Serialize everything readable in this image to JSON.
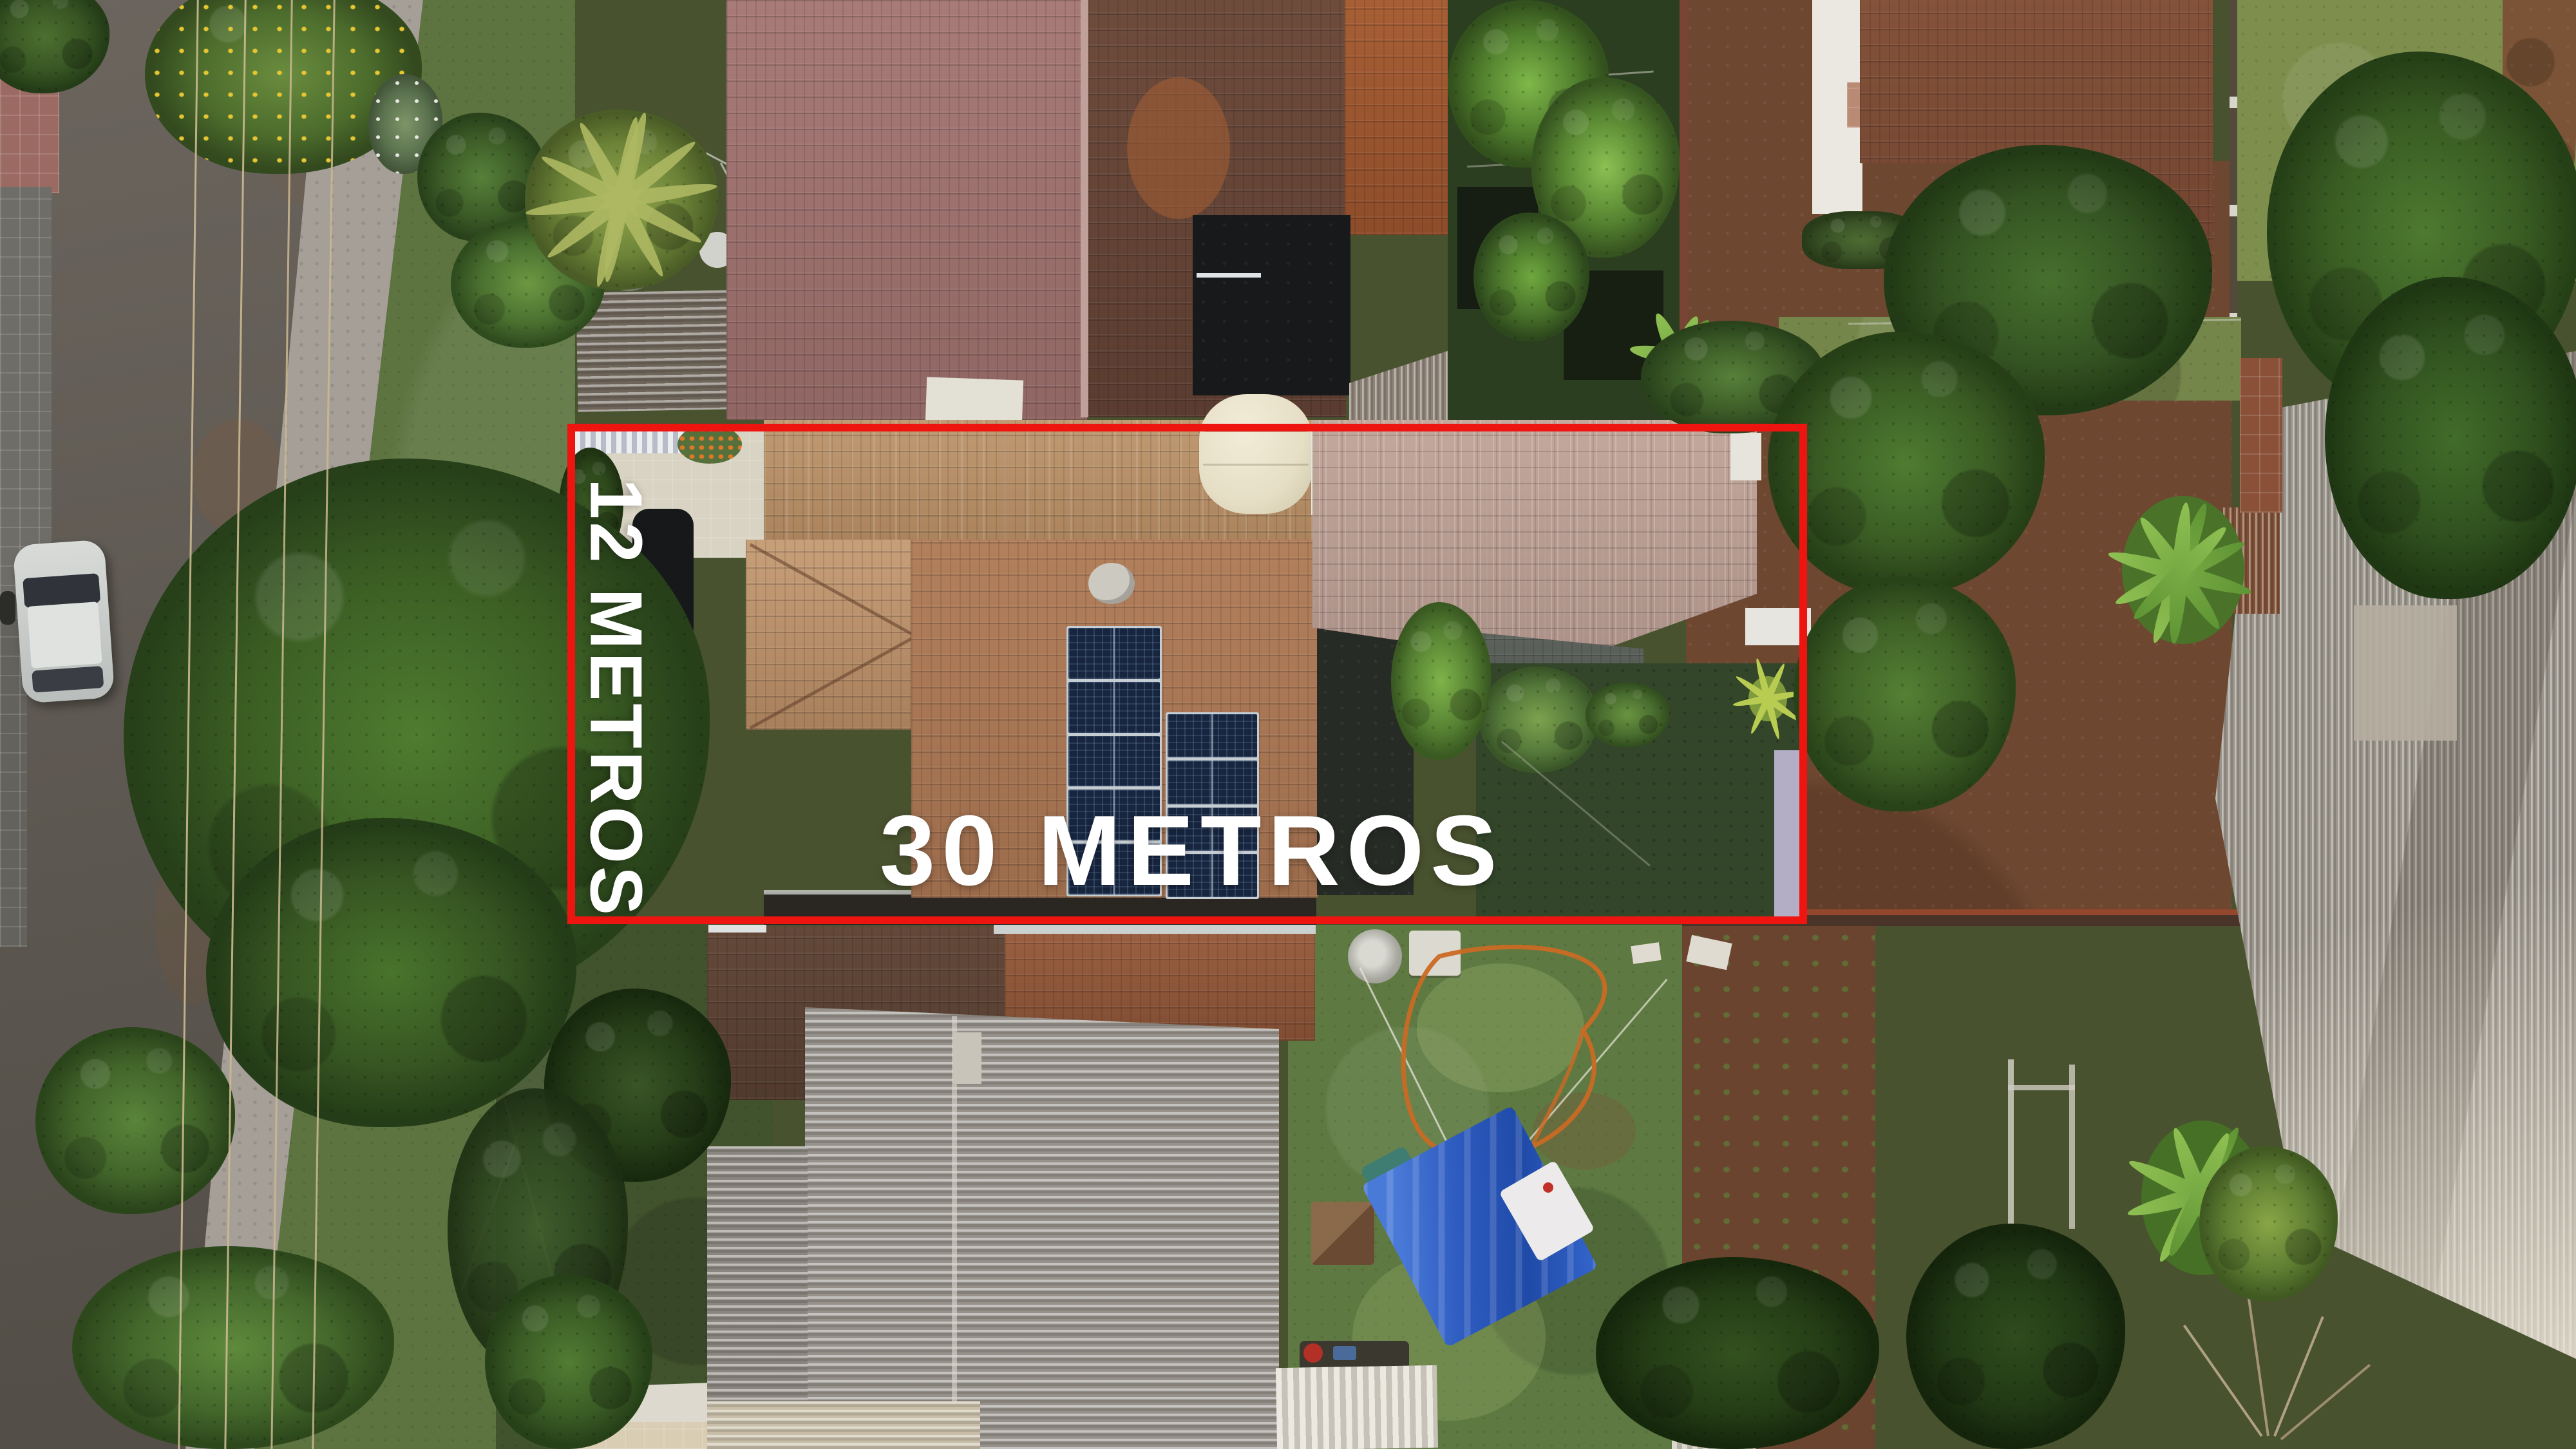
{
  "image": {
    "kind": "aerial-drone-photo",
    "subject": "residential lot outlined in red with dimension labels"
  },
  "annotation": {
    "outline_color": "#ee1511",
    "label_color": "#ffffff",
    "width_label": "30 METROS",
    "depth_label": "12 METROS"
  },
  "palette": {
    "road_asphalt": "#5c5750",
    "roof_terracotta": "#b3805c",
    "roof_pink": "#a87b78",
    "roof_dark_brown": "#6e4c3c",
    "corrugated_gray": "#96918a",
    "tree_green": "#3f6428",
    "lawn_green": "#5e7a42",
    "dirt_brown": "#6e4730",
    "tarp_blue": "#2e5cc0",
    "solar_panel_navy": "#17253f",
    "water_tank_cream": "#ece5cc"
  }
}
